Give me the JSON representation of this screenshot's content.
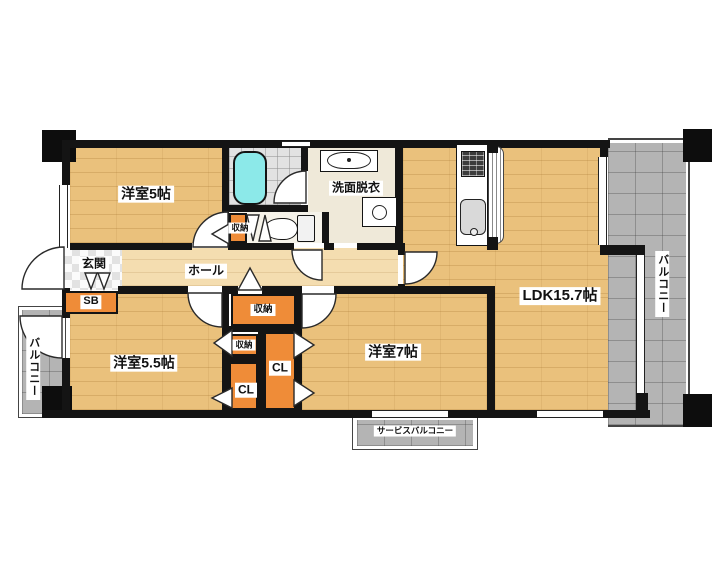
{
  "floorplan": {
    "rooms": {
      "bedroom_5": {
        "label": "洋室5帖"
      },
      "bedroom_5_5": {
        "label": "洋室5.5帖"
      },
      "bedroom_7": {
        "label": "洋室7帖"
      },
      "ldk": {
        "label": "LDK15.7帖"
      },
      "washroom": {
        "label": "洗面脱衣"
      },
      "entrance": {
        "label": "玄関"
      },
      "hall": {
        "label": "ホール"
      }
    },
    "storage": {
      "shoe_box": {
        "label": "SB"
      },
      "wc_storage": {
        "label": "収納"
      },
      "storage_top": {
        "label": "収納"
      },
      "storage_left": {
        "label": "収納"
      },
      "closet_left": {
        "label": "CL"
      },
      "closet_right": {
        "label": "CL"
      }
    },
    "balconies": {
      "right": {
        "label": "バルコニー"
      },
      "left": {
        "label": "バルコニー"
      },
      "service": {
        "label": "サービスバルコニー"
      }
    },
    "colors": {
      "wood_floor": "#eac17c",
      "hall_floor": "#f4ddb0",
      "balcony_gray": "#b4b4b4",
      "storage_orange": "#ef8c38",
      "bathtub_cyan": "#8ce9e9",
      "bath_tile": "#e2e2e2",
      "wall": "#141414"
    }
  }
}
